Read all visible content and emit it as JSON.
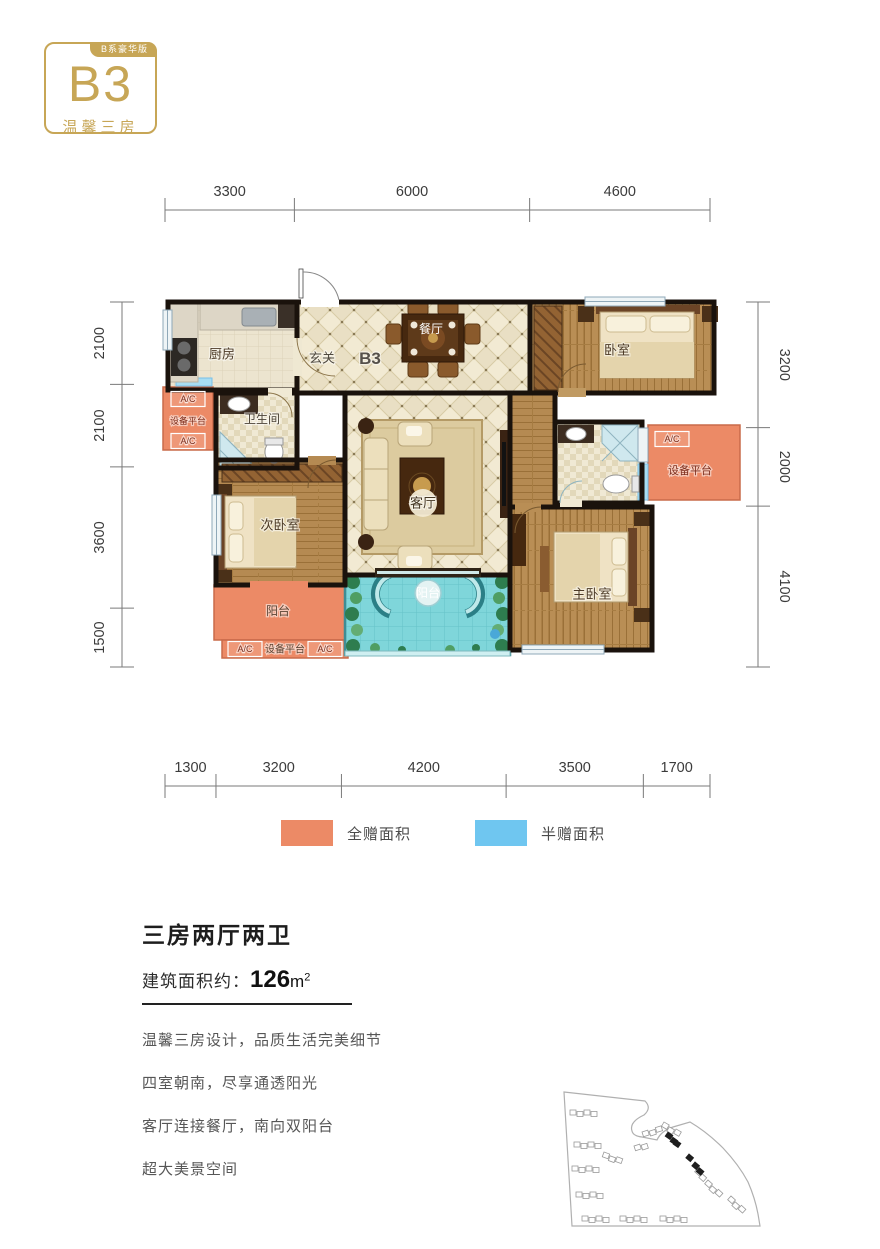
{
  "badge": {
    "tab": "B系豪华版",
    "code": "B3",
    "subtitle": "温馨三房"
  },
  "dimensions": {
    "top": {
      "labels": [
        "3300",
        "6000",
        "4600"
      ]
    },
    "bottom": {
      "labels": [
        "1300",
        "3200",
        "4200",
        "3500",
        "1700"
      ]
    },
    "left": {
      "labels": [
        "2100",
        "2100",
        "3600",
        "1500"
      ]
    },
    "right": {
      "labels": [
        "3200",
        "2000",
        "4100"
      ]
    }
  },
  "plan": {
    "unit_code": "B3",
    "labels": [
      {
        "t": "厨房",
        "x": 72,
        "y": 92,
        "s": 13,
        "c": "#4c3a26"
      },
      {
        "t": "玄关",
        "x": 172,
        "y": 96,
        "s": 13,
        "c": "#504a40"
      },
      {
        "t": "B3",
        "x": 220,
        "y": 96,
        "s": 17,
        "c": "#55504a",
        "bold": true
      },
      {
        "t": "餐厅",
        "x": 281,
        "y": 67,
        "s": 12,
        "c": "#ffffff"
      },
      {
        "t": "卧室",
        "x": 467,
        "y": 88,
        "s": 13,
        "c": "#4c3a26"
      },
      {
        "t": "卫生间",
        "x": 112,
        "y": 157,
        "s": 12,
        "c": "#4c4438"
      },
      {
        "t": "A/C",
        "x": 38,
        "y": 137,
        "s": 9,
        "c": "#7d2e1d",
        "box": true
      },
      {
        "t": "设备平台",
        "x": 38,
        "y": 159,
        "s": 9,
        "c": "#7d2e1d"
      },
      {
        "t": "A/C",
        "x": 38,
        "y": 179,
        "s": 9,
        "c": "#7d2e1d",
        "box": true
      },
      {
        "t": "次卧室",
        "x": 130,
        "y": 263,
        "s": 13,
        "c": "#4c3a26"
      },
      {
        "t": "客厅",
        "x": 273,
        "y": 241,
        "s": 13,
        "c": "#453724"
      },
      {
        "t": "主卧室",
        "x": 442,
        "y": 332,
        "s": 13,
        "c": "#4c3a26"
      },
      {
        "t": "阳台",
        "x": 128,
        "y": 349,
        "s": 12,
        "c": "#5c4534"
      },
      {
        "t": "A/C",
        "x": 95,
        "y": 387,
        "s": 9,
        "c": "#7d2e1d",
        "box": true
      },
      {
        "t": "设备平台",
        "x": 135,
        "y": 387,
        "s": 10,
        "c": "#5c4534"
      },
      {
        "t": "A/C",
        "x": 175,
        "y": 387,
        "s": 9,
        "c": "#7d2e1d",
        "box": true
      },
      {
        "t": "阳台",
        "x": 278,
        "y": 331,
        "s": 12,
        "c": "#ffffff"
      },
      {
        "t": "A/C",
        "x": 522,
        "y": 177,
        "s": 9,
        "c": "#7d2e1d",
        "box": true
      },
      {
        "t": "设备平台",
        "x": 540,
        "y": 208,
        "s": 11,
        "c": "#7d2e1d"
      }
    ]
  },
  "legend": {
    "items": [
      {
        "label": "全赠面积",
        "color": "#EC8A66"
      },
      {
        "label": "半赠面积",
        "color": "#6FC6F0"
      }
    ]
  },
  "info": {
    "title": "三房两厅两卫",
    "area_label": "建筑面积约：",
    "area_value": "126",
    "area_unit": "m",
    "area_sup": "2",
    "features": [
      "温馨三房设计，品质生活完美细节",
      "四室朝南，尽享通透阳光",
      "客厅连接餐厅，南向双阳台",
      "超大美景空间"
    ]
  },
  "colors": {
    "gold": "#c7a656",
    "gift_full": "#EC8A66",
    "gift_half": "#6FC6F0",
    "wall": "#1a120c",
    "balcony_blue": "#7fd6da"
  }
}
